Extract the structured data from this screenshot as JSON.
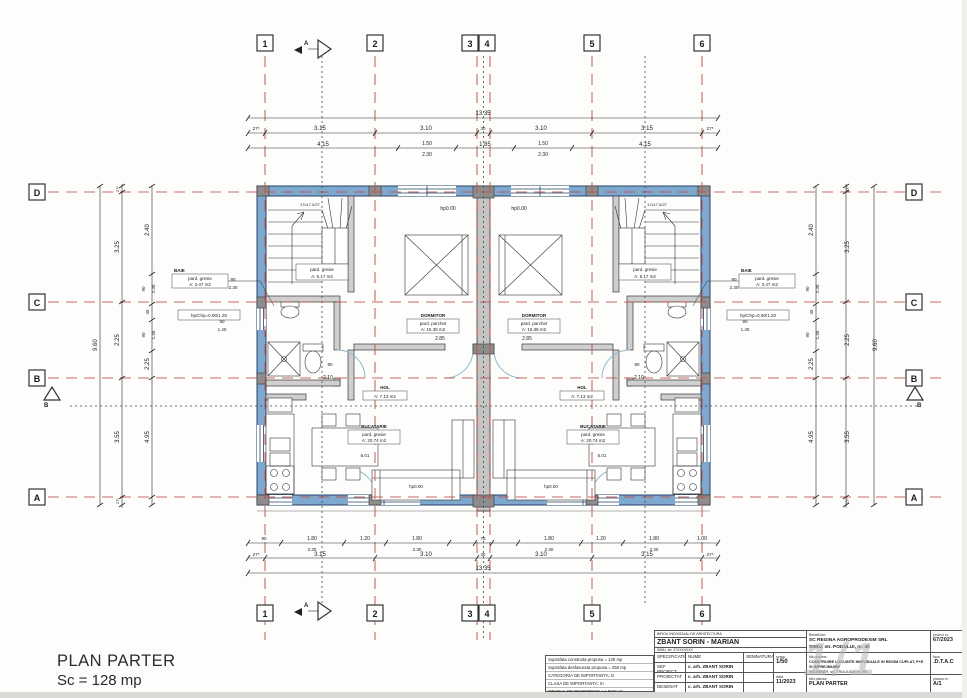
{
  "plan": {
    "title": "PLAN PARTER",
    "scale_area": "Sc = 128 mp"
  },
  "axes": {
    "cols": [
      "1",
      "2",
      "3",
      "4",
      "5",
      "6"
    ],
    "rows": [
      "D",
      "C",
      "B",
      "A"
    ]
  },
  "sections": {
    "a": "A",
    "b": "B"
  },
  "levels": {
    "hp": "hp0.00"
  },
  "dims": {
    "top_overall": "13.35",
    "axis_row": [
      "27⁵",
      "3.15",
      "3.10",
      "30",
      "3.10",
      "3.15",
      "27⁵"
    ],
    "top_detail": {
      "a": "4.15",
      "w1": "1.50",
      "w2": "2.30",
      "mid": "1.85"
    },
    "bottom_detail": [
      "90",
      "1.80",
      "2.30",
      "1.20",
      "1.80",
      "2.30",
      "75",
      "1.80",
      "2.30",
      "1.20",
      "1.80",
      "2.30",
      "1.00"
    ],
    "side_overall": "9.60",
    "left_axis": [
      "27⁵",
      "3.25",
      "2.25",
      "3.55",
      "27⁵"
    ],
    "left_detail": [
      "2.40",
      "90",
      "2.30",
      "45",
      "90",
      "1.40",
      "2.25",
      "4.95"
    ],
    "inner": {
      "bed": "2.85",
      "door": "80",
      "hall": "2.10",
      "room": "6.01",
      "win90": "90",
      "win230": "2.30",
      "win140": "1.40"
    }
  },
  "rooms": {
    "scara": {
      "l1": "pard. gresie",
      "l2": "A: 5.17 m2",
      "note": "17x17.5/27"
    },
    "dormitor": {
      "name": "DORMITOR",
      "l1": "pard. parchet",
      "l2": "A: 15.38 m2"
    },
    "baie": {
      "name": "BAIE",
      "l1": "pard. gresie",
      "l2": "A: 3.47 m2"
    },
    "hol": {
      "name": "HOL",
      "l2": "A: 7.13 m2"
    },
    "bucatarie": {
      "name": "BUCATARIE",
      "l1": "pard. gresie",
      "l2": "A: 20.74 m2"
    },
    "parapet": "hp/Chp=0.90/1.20"
  },
  "notes": {
    "l1": "Suprafata construita propusa = 128 mp",
    "l2": "Suprafata desfasurata propusa = 256 mp",
    "l3": "CATEGORIA DE IMPORTANTA: D",
    "l4": "CLASA DE IMPORTANTA: III",
    "l5": "GRADUL DE REZISTENTA LA FOC: III"
  },
  "titleblock": {
    "office_header": "BIROU INDIVIDUAL DE ARHITECTURA",
    "office_name": "ZBANT SORIN - MARIAN",
    "office_sub": "SIBIU, tel: 07XXXXXXX",
    "col_specificatie": "SPECIFICATIE",
    "col_nume": "NUME",
    "col_semnatura": "SEMNATURA",
    "scara_label": "scara",
    "scara_value": "1/50",
    "row1_label": "SEF PROIECT",
    "row1_name": "c. arh. ZBANT SORIN",
    "row2_label": "PROIECTAT",
    "row2_name": "c. arh. ZBANT SORIN",
    "row3_label": "DESENAT",
    "row3_name": "c. arh. ZBANT SORIN",
    "data_label": "data",
    "data_value": "11/2023",
    "beneficiar_label": "Beneficiar:",
    "beneficiar_line1": "SC REGINA AGROPRODEXIM SRL",
    "beneficiar_line2": "SIBIU, str. PODULUI, nr. 40",
    "proiect_label": "proiect nr.",
    "proiect_value": "67/2023",
    "titlu_proiect_label": "titlu proiect:",
    "titlu_proiect_line1": "CONSTRUIRE LOCUINTE INDIVIDUALE IN REGIM CUPLAT, P+E",
    "titlu_proiect_line2": "SI IMPREJMUIRE",
    "titlu_proiect_line3": "SELIMBAR, str. TRIAJULUI nr. FN",
    "faza_label": "faza",
    "faza_value": ".D.T.A.C",
    "plansa_label": "titlu plansa:",
    "plansa_value": "PLAN PARTER",
    "plansa_nr_label": "plansa nr.",
    "plansa_nr_value": "A/1",
    "watermark": "1/1"
  }
}
